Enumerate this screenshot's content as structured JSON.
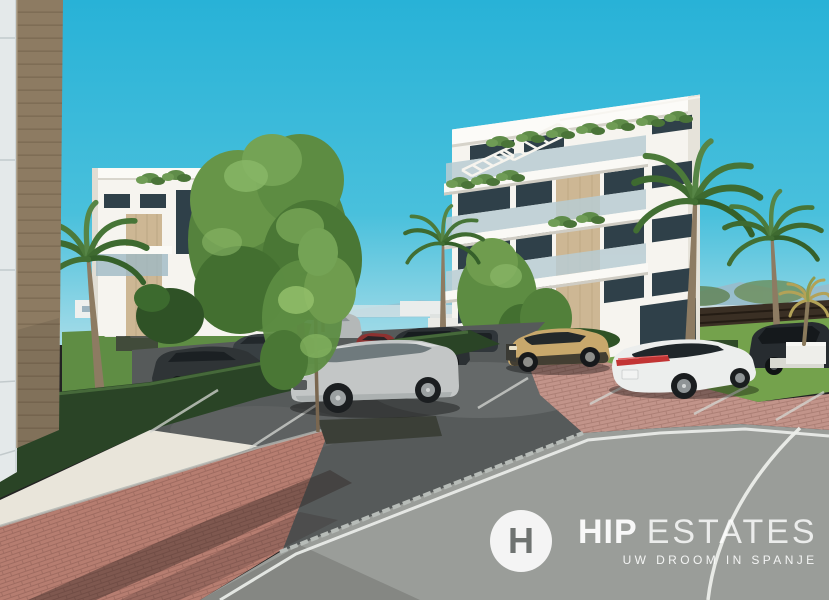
{
  "watermark": {
    "logo_monogram": "H",
    "brand_bold": "HIP",
    "brand_light": "ESTATES",
    "tagline": "UW DROOM IN SPANJE"
  },
  "colors": {
    "sky_top": "#28b2d7",
    "sky_horizon": "#a6dce8",
    "hills": "#9fb7c6",
    "distant_white": "#eef0ee",
    "fence_brown": "#3a2f24",
    "lawn": "#74a24c",
    "lawn_dark": "#5f8d44",
    "hedge": "#2a4426",
    "tree_green": "#5d8c42",
    "palm_green": "#4c7a3a",
    "building_white": "#f6f4ef",
    "accent_tan": "#cdb794",
    "glass_dark": "#2f4049",
    "wood_facade": "#8d7b62",
    "panel_gray": "#e4e9ea",
    "parking_asphalt": "#565a5a",
    "road_asphalt": "#9a9d99",
    "paver_red": "#b67d70",
    "paver_red_light": "#c2948а",
    "gravel": "#e9e5da",
    "curb": "#b0b5b1",
    "line_white": "#eceeea",
    "car_silver": "#c3c6c6",
    "car_gold": "#c8a86c",
    "car_white": "#eceeed",
    "car_dark": "#2f3436",
    "car_red": "#8d3130",
    "taillight_red": "#c23434",
    "watermark_white": "#ffffff"
  }
}
